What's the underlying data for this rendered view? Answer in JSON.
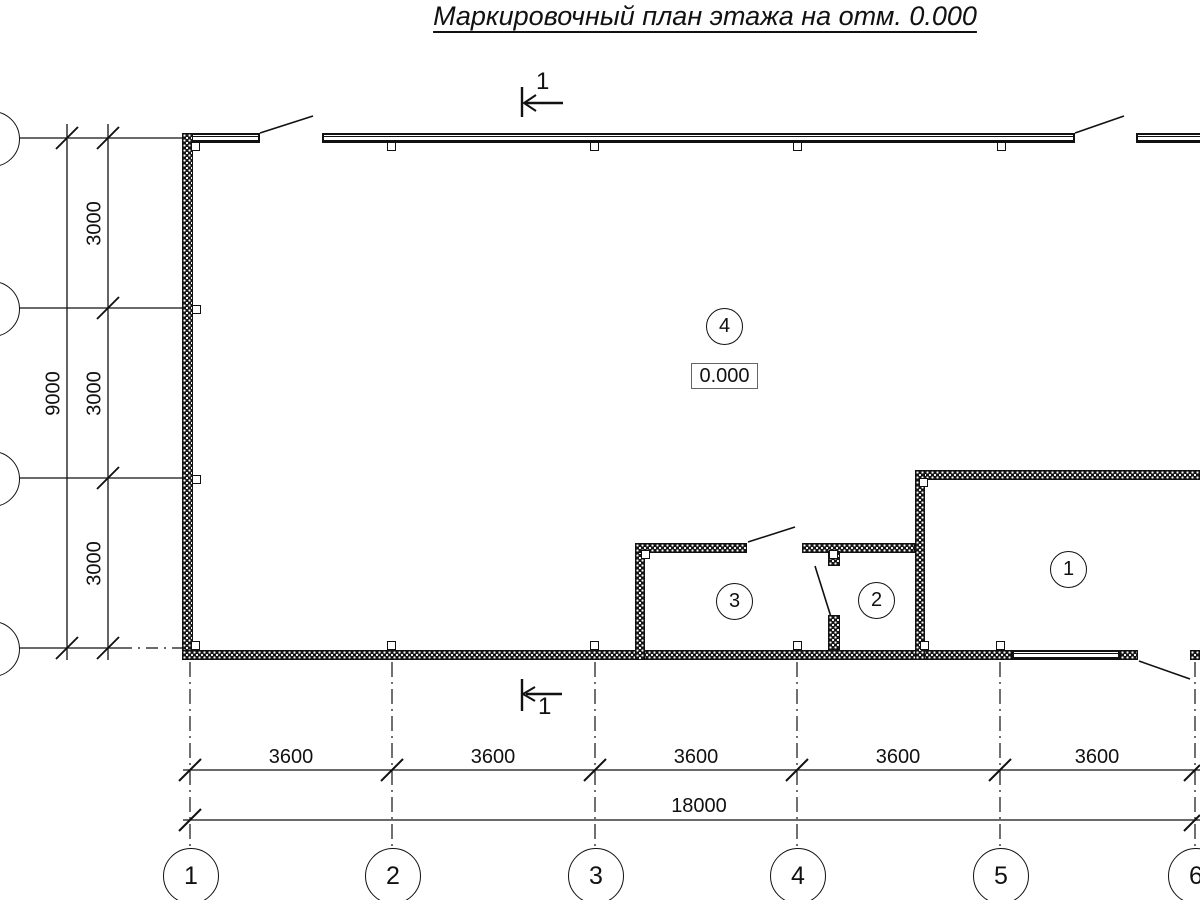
{
  "title": {
    "text": "Маркировочный план этажа на отм. 0.000"
  },
  "section_mark": {
    "top": "1",
    "bottom": "1"
  },
  "elevation": {
    "value": "0.000"
  },
  "rooms": {
    "r1": "1",
    "r2": "2",
    "r3": "3",
    "r4": "4"
  },
  "dimensions": {
    "left": {
      "seg1": "3000",
      "seg2": "3000",
      "seg3": "3000",
      "total": "9000"
    },
    "bottom": {
      "seg1": "3600",
      "seg2": "3600",
      "seg3": "3600",
      "seg4": "3600",
      "seg5": "3600",
      "total": "18000"
    }
  },
  "axes": {
    "bottom": {
      "a1": "1",
      "a2": "2",
      "a3": "3",
      "a4": "4",
      "a5": "5",
      "a6": "6"
    }
  },
  "colors": {
    "ink": "#111111",
    "paper": "#ffffff"
  }
}
